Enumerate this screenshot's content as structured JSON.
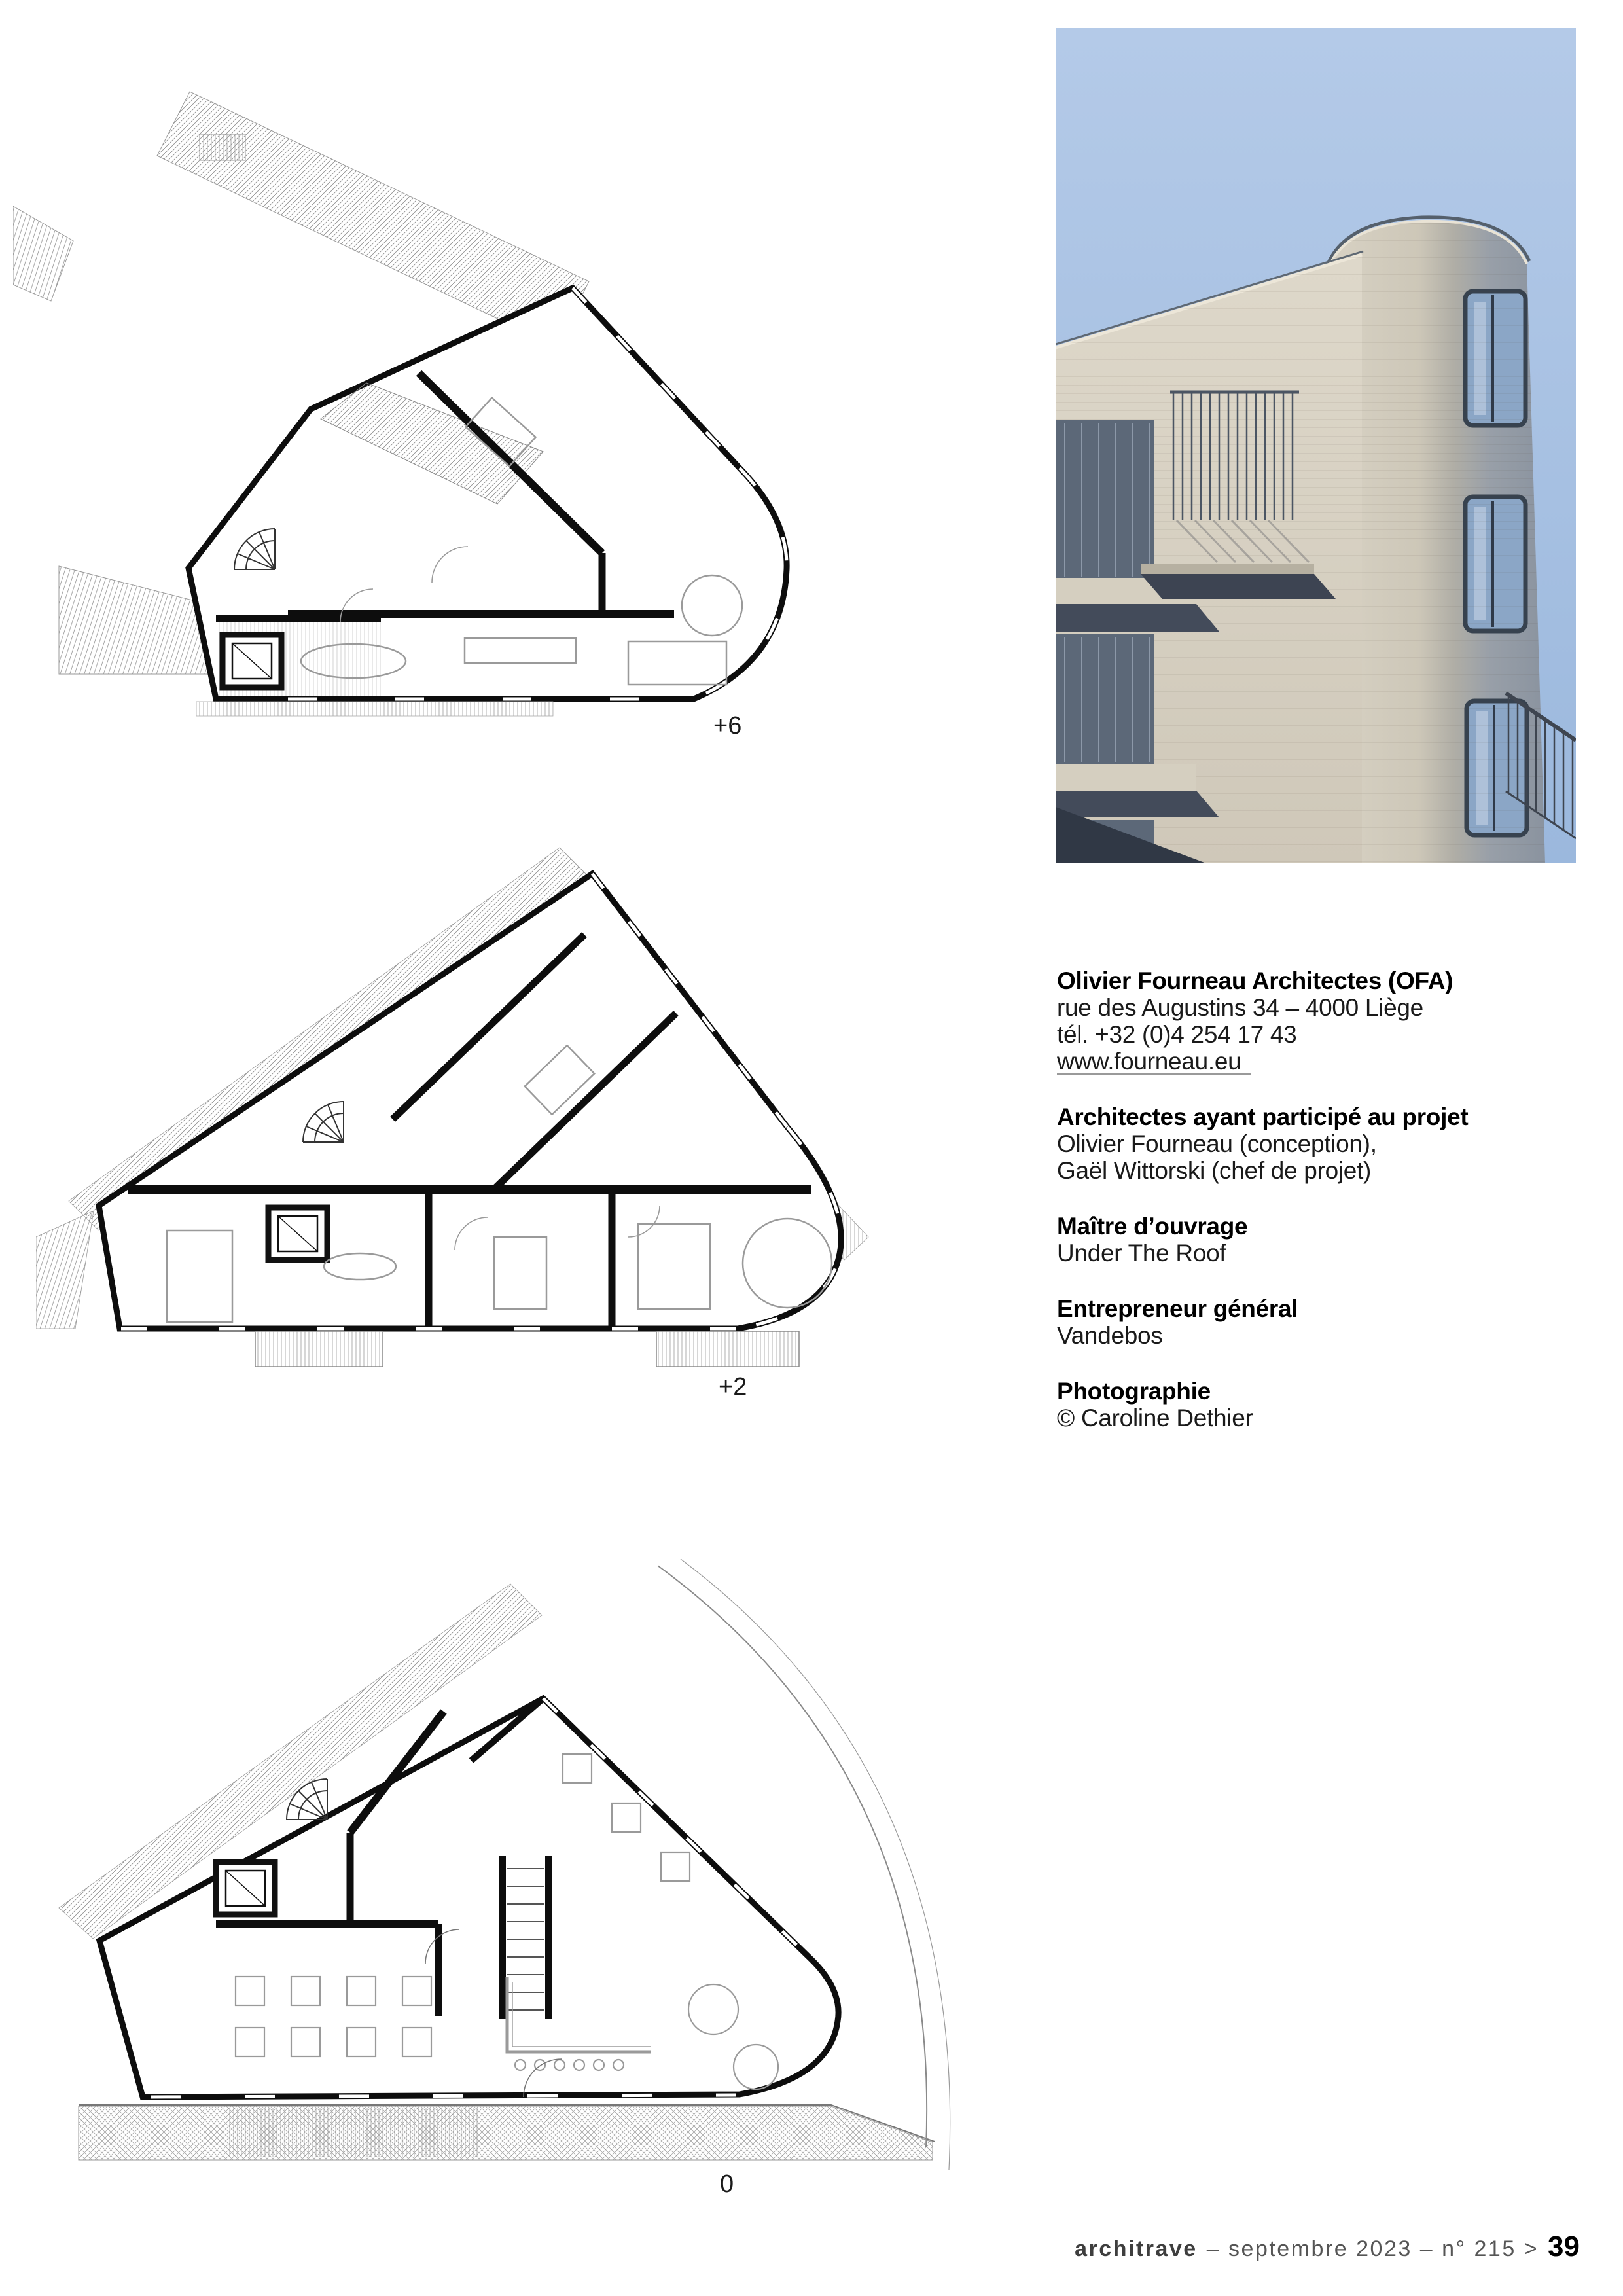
{
  "plans": {
    "items": [
      {
        "id": "plan-plus6",
        "label": "+6"
      },
      {
        "id": "plan-plus2",
        "label": "+2"
      },
      {
        "id": "plan-ground",
        "label": "0"
      }
    ]
  },
  "photo": {
    "colors": {
      "sky": "#a6c0e2",
      "facade": "#d9d3c5",
      "tower": "#8d96a2",
      "glass": "#8ba6c6",
      "frame": "#37424f"
    }
  },
  "info": {
    "sections": [
      {
        "heading": "Olivier Fourneau Architectes (OFA)",
        "lines": [
          "rue des Augustins 34 – 4000 Liège",
          "tél. +32 (0)4 254 17 43"
        ],
        "link": "www.fourneau.eu"
      },
      {
        "heading": "Architectes ayant participé au projet",
        "lines": [
          "Olivier Fourneau (conception),",
          "Gaël Wittorski (chef de projet)"
        ]
      },
      {
        "heading": "Maître d’ouvrage",
        "lines": [
          "Under The Roof"
        ]
      },
      {
        "heading": "Entrepreneur général",
        "lines": [
          "Vandebos"
        ]
      },
      {
        "heading": "Photographie",
        "lines": [
          "© Caroline Dethier"
        ]
      }
    ]
  },
  "footer": {
    "brand": "architrave",
    "middle": "– septembre 2023 – n° 215 >",
    "page_number": "39"
  }
}
